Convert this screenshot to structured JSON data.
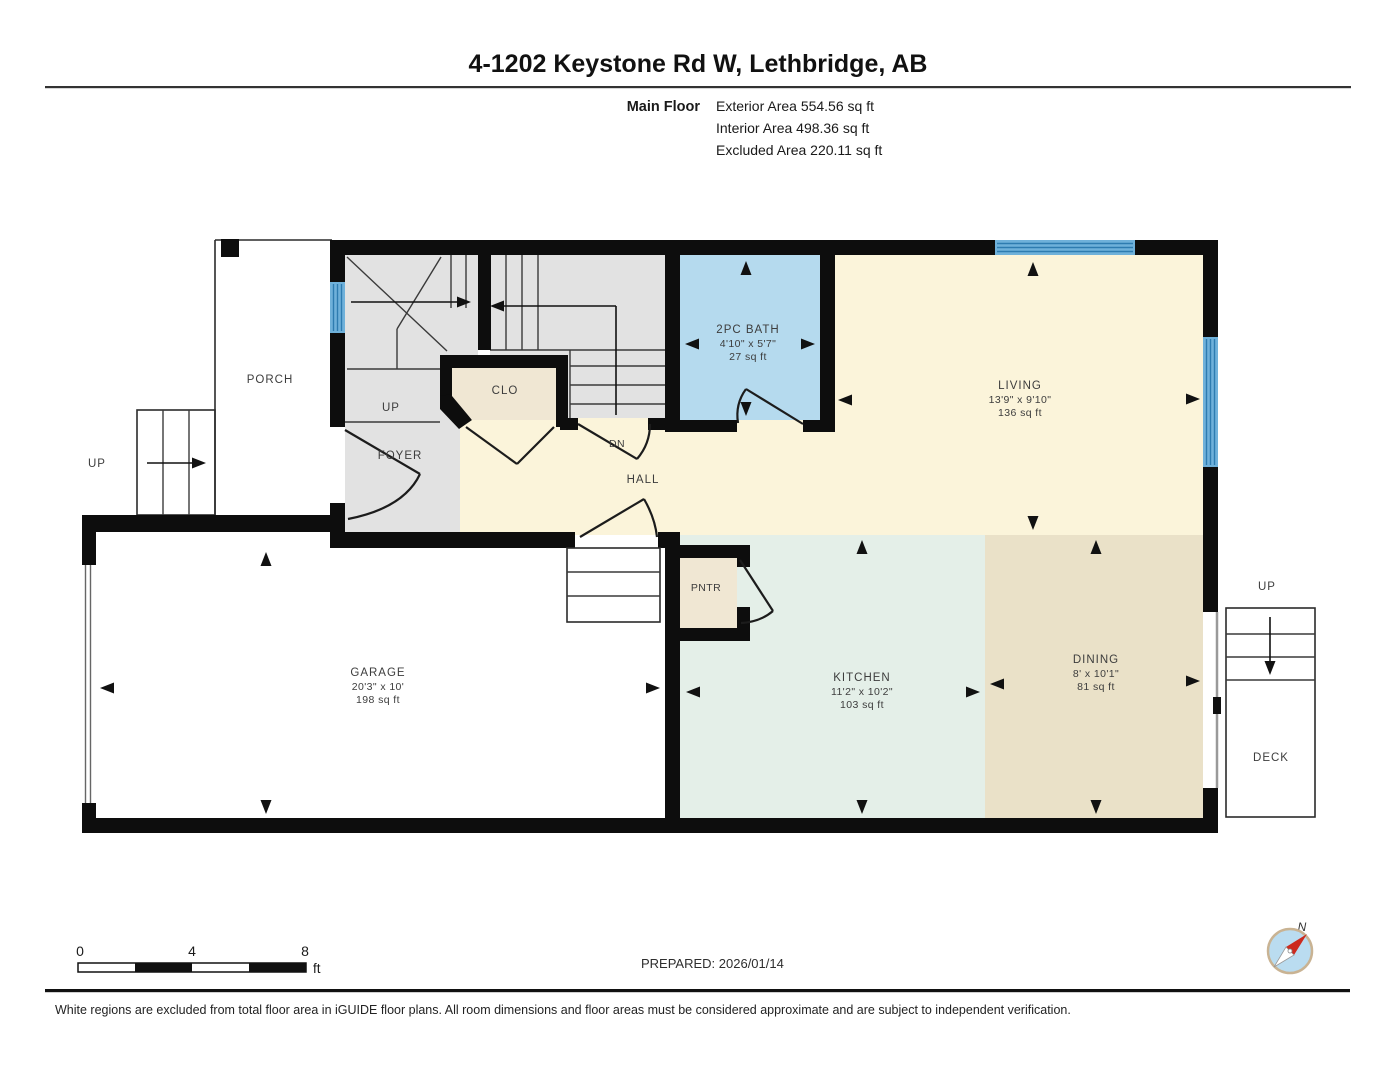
{
  "header": {
    "title": "4-1202 Keystone Rd W, Lethbridge, AB",
    "floor_label": "Main Floor",
    "areas": {
      "exterior": "Exterior Area 554.56 sq ft",
      "interior": "Interior Area 498.36 sq ft",
      "excluded": "Excluded Area 220.11 sq ft"
    }
  },
  "rooms": {
    "porch": {
      "label": "PORCH"
    },
    "foyer": {
      "label": "FOYER"
    },
    "closet": {
      "label": "CLO"
    },
    "hall": {
      "label": "HALL"
    },
    "bath": {
      "label": "2PC BATH",
      "dims": "4'10\" x 5'7\"",
      "area": "27 sq ft"
    },
    "living": {
      "label": "LIVING",
      "dims": "13'9\" x 9'10\"",
      "area": "136 sq ft"
    },
    "garage": {
      "label": "GARAGE",
      "dims": "20'3\" x 10'",
      "area": "198 sq ft"
    },
    "pantry": {
      "label": "PNTR"
    },
    "kitchen": {
      "label": "KITCHEN",
      "dims": "11'2\" x 10'2\"",
      "area": "103 sq ft"
    },
    "dining": {
      "label": "DINING",
      "dims": "8' x 10'1\"",
      "area": "81 sq ft"
    },
    "deck": {
      "label": "DECK"
    }
  },
  "stairs": {
    "exterior_up": "UP",
    "interior_up": "UP",
    "interior_down": "DN",
    "deck_up": "UP"
  },
  "scale_bar": {
    "tick0": "0",
    "tick1": "4",
    "tick2": "8",
    "unit": "ft"
  },
  "prepared_label": "PREPARED: 2026/01/14",
  "compass": {
    "north_label": "N"
  },
  "disclaimer": "White regions are excluded from total floor area in iGUIDE floor plans. All room dimensions and floor areas must be considered approximate and are subject to independent verification.",
  "colors": {
    "wall": "#0d0d0d",
    "window_blue": "#6fb1da",
    "bath_fill": "#b5daee",
    "living_fill": "#fbf4da",
    "kitchen_fill": "#e4efe8",
    "dining_fill": "#eae1c8",
    "closet_fill": "#f0e7d3",
    "stairs_fill": "#e2e2e2",
    "compass_red": "#cc2a1e"
  }
}
